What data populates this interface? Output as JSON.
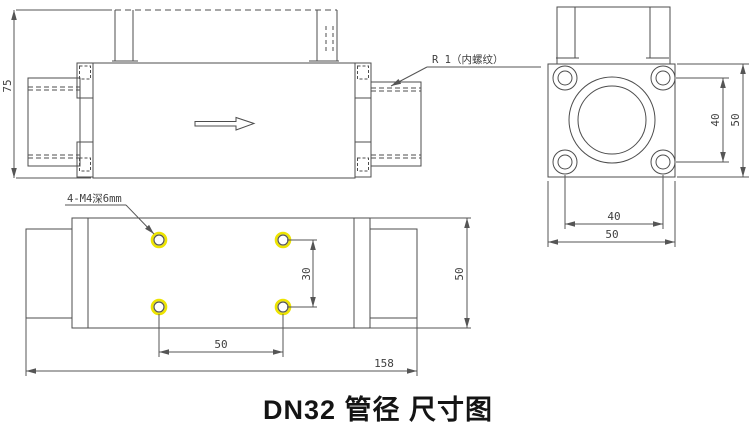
{
  "title": "DN32 管径 尺寸图",
  "side_view": {
    "dim_height": "75",
    "thread_note": "R 1（内螺纹）"
  },
  "end_view": {
    "dim_hole_pitch_vertical": "40",
    "dim_flange_height": "50",
    "dim_hole_pitch_horizontal": "40",
    "dim_flange_width": "50"
  },
  "bottom_view": {
    "hole_note": "4-M4深6mm",
    "dim_hole_pitch_vertical": "30",
    "dim_hole_pitch_horizontal": "50",
    "dim_overall_length": "158",
    "dim_body_width": "50"
  },
  "colors": {
    "line_color": "#4d4d4d",
    "hole_highlight": "#ede400"
  }
}
